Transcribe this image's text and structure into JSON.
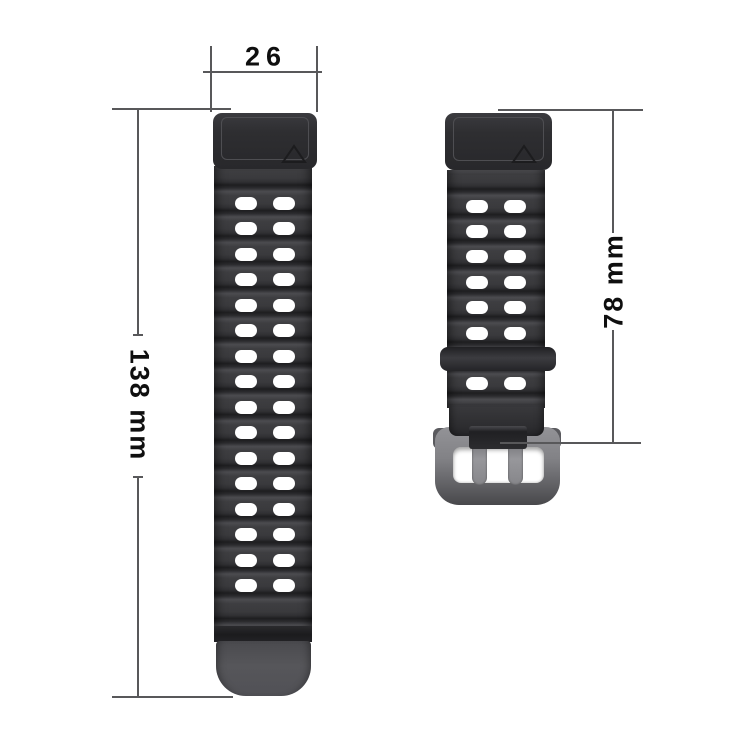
{
  "product_diagram": {
    "band_width_label": "26",
    "band_long_length_label": "138 mm",
    "band_short_length_label": "78 mm"
  },
  "straps": {
    "left": {
      "hole_rows": 16,
      "hole_columns": 2
    },
    "right": {
      "hole_rows_above_keeper": 6,
      "hole_rows_below_keeper": 1,
      "hole_columns": 2
    }
  },
  "icons": {
    "left_connector_mark": "triangle-icon",
    "right_connector_mark": "triangle-icon"
  },
  "colors": {
    "background": "#ffffff",
    "strap_body": "#39393c",
    "strap_connector": "#2d2d30",
    "strap_tip": "#55555a",
    "keeper": "#2b2b2e",
    "buckle_frame": "#828286",
    "dimension_line": "#58585a",
    "label_text": "#0f0f0f"
  }
}
